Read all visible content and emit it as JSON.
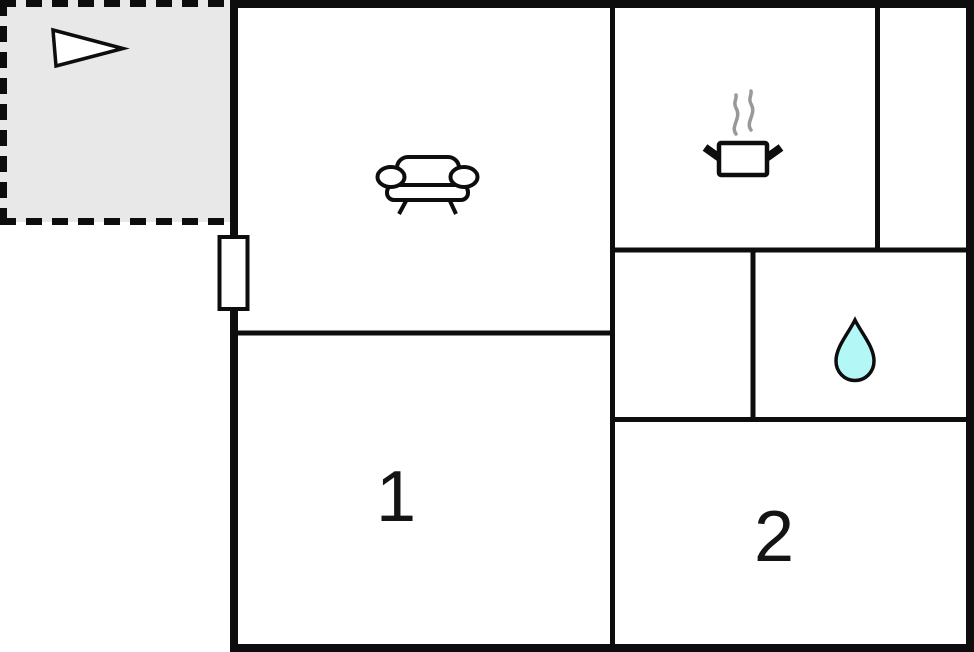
{
  "image_type": "apartment-floor-plan",
  "floor_plan": {
    "rooms": {
      "terrace": {
        "border_style": "dashed",
        "icon": "direction-arrow-icon"
      },
      "living_room": {
        "icon": "sofa-icon"
      },
      "kitchen": {
        "icon": "cooking-pot-icon"
      },
      "bathroom": {
        "icon": "water-drop-icon"
      },
      "bedroom_1": {
        "label": "1"
      },
      "bedroom_2": {
        "label": "2"
      }
    },
    "features": {
      "window_marker": "white rectangle on left exterior wall",
      "unlabeled_spaces": [
        "hallway",
        "narrow room top-right"
      ]
    },
    "colors": {
      "wall": "#0d0d0d",
      "terrace_fill": "#e8e8e8",
      "water_drop_fill": "#b4f7f7",
      "steam": "#999999",
      "arrow_fill": "#ffffff",
      "background": "#ffffff"
    }
  }
}
